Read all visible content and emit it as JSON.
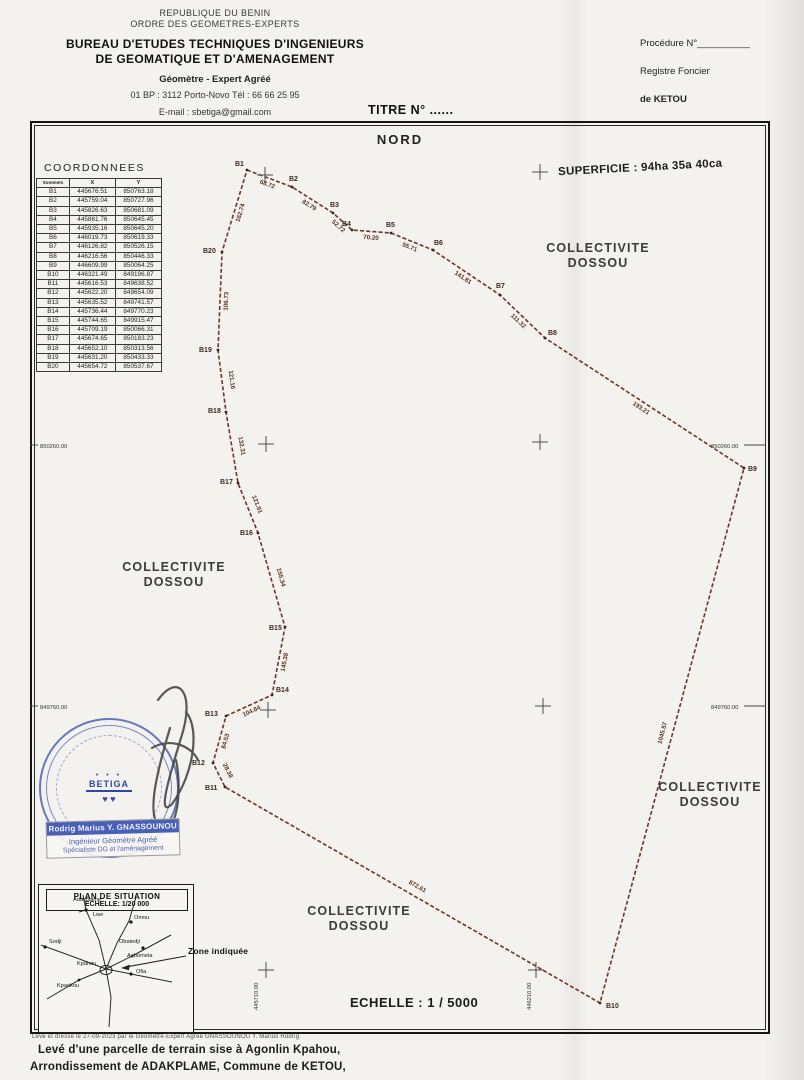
{
  "page": {
    "bg": "#f3f2ee",
    "boundary_color": "#6e3528",
    "stamp_blue": "#3c52a6",
    "ink": "#222222"
  },
  "letterhead": {
    "line1": "REPUBLIQUE DU BENIN",
    "line2": "ORDRE DES GEOMETRES-EXPERTS",
    "line3": "BUREAU D'ETUDES TECHNIQUES D'INGENIEURS",
    "line4": "DE GEOMATIQUE ET D'AMENAGEMENT",
    "line5": "Géomètre - Expert  Agréé",
    "line6": "01 BP : 3112 Porto-Novo Tél : 66 66 25 95",
    "line7": "E-mail : sbetiga@gmail.com"
  },
  "registry": {
    "procedure": "Procédure N°__________",
    "line2": "Registre Foncier",
    "line3": "de KETOU"
  },
  "title": "TITRE N° ......",
  "plan": {
    "north": "NORD",
    "superficie": "SUPERFICIE : 94ha 35a 40ca",
    "echelle": "ECHELLE : 1 / 5000",
    "collectivites": [
      {
        "lines": [
          "COLLECTIVITE",
          "DOSSOU"
        ],
        "cx": 598,
        "cy": 241
      },
      {
        "lines": [
          "COLLECTIVITE",
          "DOSSOU"
        ],
        "cx": 174,
        "cy": 560
      },
      {
        "lines": [
          "COLLECTIVITE",
          "DOSSOU"
        ],
        "cx": 710,
        "cy": 780
      },
      {
        "lines": [
          "COLLECTIVITE",
          "DOSSOU"
        ],
        "cx": 359,
        "cy": 904
      }
    ],
    "grid": {
      "h_labels": [
        {
          "text": "850260.00",
          "x": 40,
          "y": 448
        },
        {
          "text": "849760.00",
          "x": 40,
          "y": 709
        },
        {
          "text": "850260.00",
          "x": 711,
          "y": 448
        },
        {
          "text": "849760.00",
          "x": 711,
          "y": 709
        }
      ],
      "v_labels": [
        {
          "text": "445710.00",
          "x": 258,
          "y": 1010
        },
        {
          "text": "446210.00",
          "x": 531,
          "y": 1010
        }
      ],
      "crosses": [
        [
          265,
          175
        ],
        [
          540,
          172
        ],
        [
          266,
          444
        ],
        [
          540,
          442
        ],
        [
          268,
          710
        ],
        [
          543,
          706
        ],
        [
          266,
          970
        ],
        [
          536,
          970
        ]
      ],
      "ticks": [
        [
          30,
          445,
          38,
          445
        ],
        [
          30,
          706,
          38,
          706
        ],
        [
          744,
          445,
          766,
          445
        ],
        [
          744,
          706,
          766,
          706
        ]
      ]
    },
    "parcel": {
      "vertices": [
        {
          "name": "B1",
          "x": 247,
          "y": 170,
          "lx": -12,
          "ly": -4
        },
        {
          "name": "B2",
          "x": 292,
          "y": 187,
          "lx": -3,
          "ly": -6
        },
        {
          "name": "B3",
          "x": 333,
          "y": 213,
          "lx": -3,
          "ly": -6
        },
        {
          "name": "B4",
          "x": 352,
          "y": 230,
          "lx": -10,
          "ly": -4
        },
        {
          "name": "B5",
          "x": 391,
          "y": 233,
          "lx": -5,
          "ly": -6
        },
        {
          "name": "B6",
          "x": 433,
          "y": 250,
          "lx": 1,
          "ly": -5
        },
        {
          "name": "B7",
          "x": 500,
          "y": 295,
          "lx": -4,
          "ly": -7
        },
        {
          "name": "B8",
          "x": 545,
          "y": 338,
          "lx": 3,
          "ly": -3
        },
        {
          "name": "B9",
          "x": 744,
          "y": 468,
          "lx": 4,
          "ly": 3
        },
        {
          "name": "B10",
          "x": 600,
          "y": 1003,
          "lx": 6,
          "ly": 5
        },
        {
          "name": "B11",
          "x": 225,
          "y": 787,
          "lx": -20,
          "ly": 3
        },
        {
          "name": "B12",
          "x": 213,
          "y": 763,
          "lx": -21,
          "ly": 2
        },
        {
          "name": "B13",
          "x": 226,
          "y": 716,
          "lx": -21,
          "ly": 0
        },
        {
          "name": "B14",
          "x": 272,
          "y": 695,
          "lx": 4,
          "ly": -3
        },
        {
          "name": "B15",
          "x": 285,
          "y": 627,
          "lx": -16,
          "ly": 3
        },
        {
          "name": "B16",
          "x": 258,
          "y": 533,
          "lx": -18,
          "ly": 2
        },
        {
          "name": "B17",
          "x": 238,
          "y": 483,
          "lx": -18,
          "ly": 1
        },
        {
          "name": "B18",
          "x": 226,
          "y": 412,
          "lx": -18,
          "ly": 1
        },
        {
          "name": "B19",
          "x": 218,
          "y": 350,
          "lx": -19,
          "ly": 2
        },
        {
          "name": "B20",
          "x": 222,
          "y": 252,
          "lx": -19,
          "ly": 1
        }
      ],
      "edge_lengths": [
        "68.72",
        "82.79",
        "52.72",
        "70.20",
        "55.71",
        "141.81",
        "111.32",
        "193.21",
        "1045.57",
        "872.61",
        "28.38",
        "84.53",
        "104.64",
        "145.38",
        "155.34",
        "121.91",
        "132.31",
        "121.16",
        "106.73",
        "162.74"
      ]
    }
  },
  "coordinates_table": {
    "title": "COORDONNEES",
    "headers": [
      "Sommets",
      "X",
      "Y"
    ],
    "rows": [
      [
        "B1",
        "445676.51",
        "850763.18"
      ],
      [
        "B2",
        "445759.04",
        "850727.96"
      ],
      [
        "B3",
        "445826.63",
        "850681.09"
      ],
      [
        "B4",
        "445861.76",
        "850645.45"
      ],
      [
        "B5",
        "445935.16",
        "850645.20"
      ],
      [
        "B6",
        "446019.73",
        "850619.33"
      ],
      [
        "B7",
        "446126.82",
        "850526.15"
      ],
      [
        "B8",
        "446216.56",
        "850446.33"
      ],
      [
        "B9",
        "446609.99",
        "850064.25"
      ],
      [
        "B10",
        "446321.49",
        "849196.87"
      ],
      [
        "B11",
        "445616.53",
        "849638.52"
      ],
      [
        "B12",
        "445622.20",
        "849654.09"
      ],
      [
        "B13",
        "445635.52",
        "849741.57"
      ],
      [
        "B14",
        "445736.44",
        "849770.23"
      ],
      [
        "B15",
        "445744.65",
        "849915.47"
      ],
      [
        "B16",
        "445709.19",
        "850066.31"
      ],
      [
        "B17",
        "445674.65",
        "850183.23"
      ],
      [
        "B18",
        "445652.10",
        "850313.56"
      ],
      [
        "B19",
        "445631.20",
        "850433.33"
      ],
      [
        "B20",
        "445654.72",
        "850537.67"
      ]
    ]
  },
  "stamp": {
    "logo": "BETIGA",
    "name": "Rodrig Marius Y. GNASSOUNOU",
    "role1": "Ingénieur Géomètre Agréé",
    "role2": "Spécialiste DG et l'aménagement"
  },
  "situation": {
    "title": "PLAN DE SITUATION",
    "scale": "ECHELLE: 1/20 000",
    "zone": "Zone indiquée",
    "villages": [
      {
        "name": "Adakplame",
        "x": 34,
        "y": 16
      },
      {
        "name": "Lwe",
        "x": 54,
        "y": 31
      },
      {
        "name": "Omou",
        "x": 95,
        "y": 34
      },
      {
        "name": "Sodji",
        "x": 10,
        "y": 58
      },
      {
        "name": "Obatedji",
        "x": 80,
        "y": 58
      },
      {
        "name": "Agbometa",
        "x": 88,
        "y": 72
      },
      {
        "name": "Kpahou",
        "x": 38,
        "y": 80
      },
      {
        "name": "Ofia",
        "x": 97,
        "y": 88
      },
      {
        "name": "Kpankou",
        "x": 18,
        "y": 102
      }
    ]
  },
  "footer": {
    "small": "Levé et dressé le 27-09-2023 par le Géomètre-Expert Agréé GNASSOUNOU Y. Marius Rodrig",
    "line1": "Levé d'une parcelle de terrain sise à Agonlin Kpahou,",
    "line2": "Arrondissement de ADAKPLAME, Commune de KETOU,"
  }
}
